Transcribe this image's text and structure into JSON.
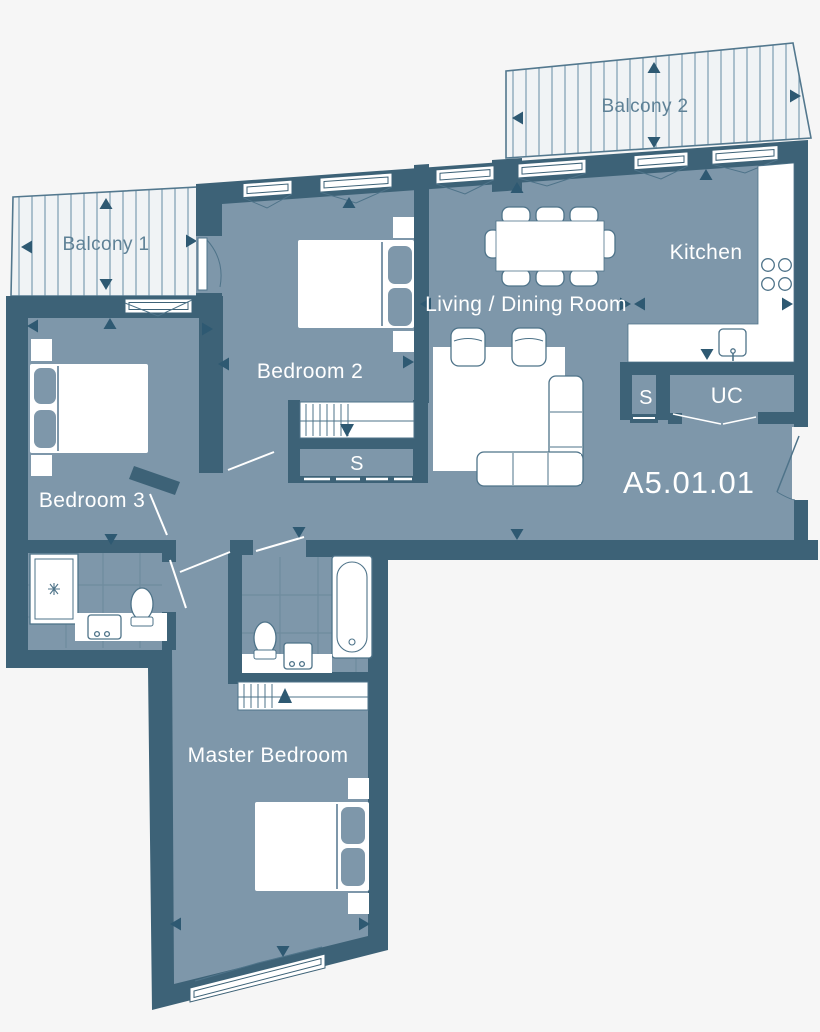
{
  "plan": {
    "unit_number": "A5.01.01",
    "rooms": {
      "balcony1": {
        "label": "Balcony 1"
      },
      "balcony2": {
        "label": "Balcony 2"
      },
      "bedroom2": {
        "label": "Bedroom 2"
      },
      "bedroom3": {
        "label": "Bedroom 3"
      },
      "living": {
        "label": "Living / Dining Room"
      },
      "kitchen": {
        "label": "Kitchen"
      },
      "master": {
        "label": "Master Bedroom"
      },
      "storage_hall": {
        "label": "S"
      },
      "storage_kitchen": {
        "label": "S"
      },
      "utility": {
        "label": "UC"
      }
    },
    "colors": {
      "wall": "#3d6277",
      "floor": "#7e97aa",
      "balcony_background": "#f0f3f5",
      "balcony_stripe": "#7c9cb0",
      "outline": "#4e7389",
      "arrow": "#2e5972",
      "label_text": "#ffffff",
      "balcony_text": "#5e8196",
      "page_background": "#f6f6f6"
    }
  }
}
